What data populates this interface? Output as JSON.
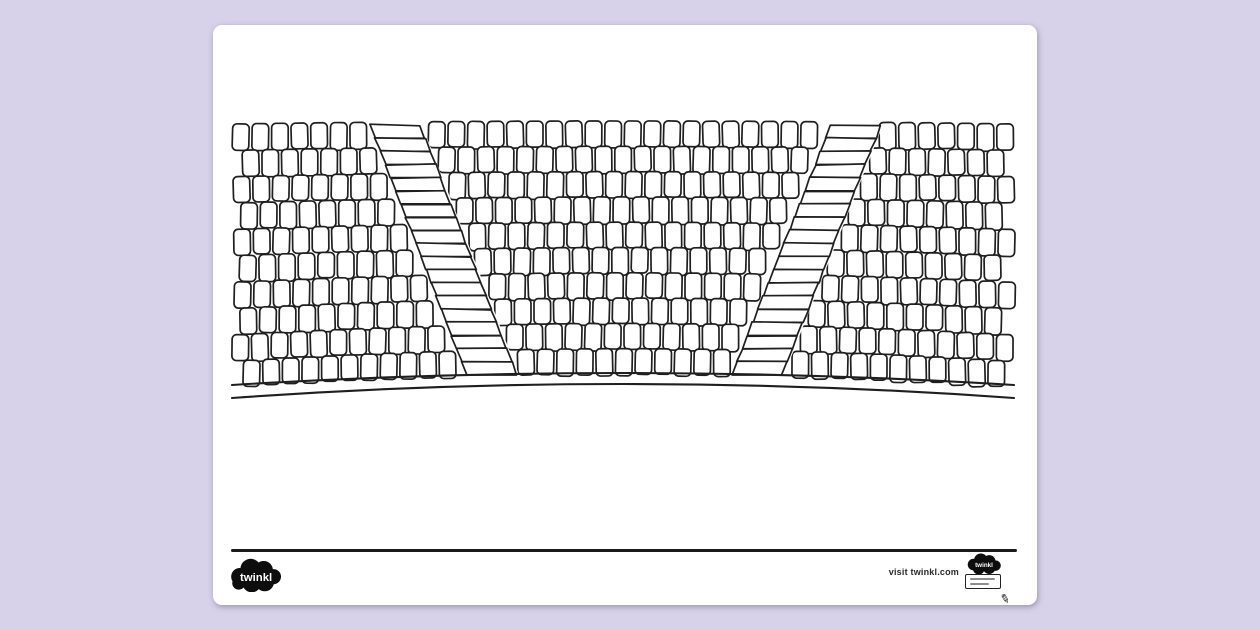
{
  "page": {
    "background_color": "#d7d1e9",
    "paper_color": "#ffffff"
  },
  "footer": {
    "logo_text": "twinkl",
    "visit_text": "visit twinkl.com",
    "badge_logo_text": "twinkl"
  },
  "illustration": {
    "name": "amphitheatre-seating-colouring-drawing",
    "description": "Black and white outline drawing of curved tiers of amphitheatre seats with two diagonal staircase aisles converging toward the front, above a curved stage edge line",
    "stroke": "#1f1f1f",
    "fill": "#ffffff",
    "rows": 10,
    "row_top": 96,
    "row_pitch": 25.3,
    "seat_pitch": 19.6,
    "seat_width": 16.6,
    "seat_height": 26.5,
    "left": 19,
    "right": 801,
    "center_x": 410,
    "sag_base": 3,
    "sag_step": 1.1,
    "stairs": [
      {
        "top_x": 182,
        "top_y": 100,
        "bottom_x": 279,
        "bottom_y": 350,
        "steps": 19,
        "half_width": 25
      },
      {
        "top_x": 643,
        "top_y": 100,
        "bottom_x": 544,
        "bottom_y": 350,
        "steps": 19,
        "half_width": 25
      }
    ],
    "ground_line": {
      "x1": 19,
      "y1": 360,
      "cx": 410,
      "cy": 336,
      "x2": 801,
      "y2": 360
    },
    "stage_line": {
      "x1": 19,
      "y1": 373,
      "cx": 410,
      "cy": 345,
      "x2": 801,
      "y2": 373
    }
  }
}
